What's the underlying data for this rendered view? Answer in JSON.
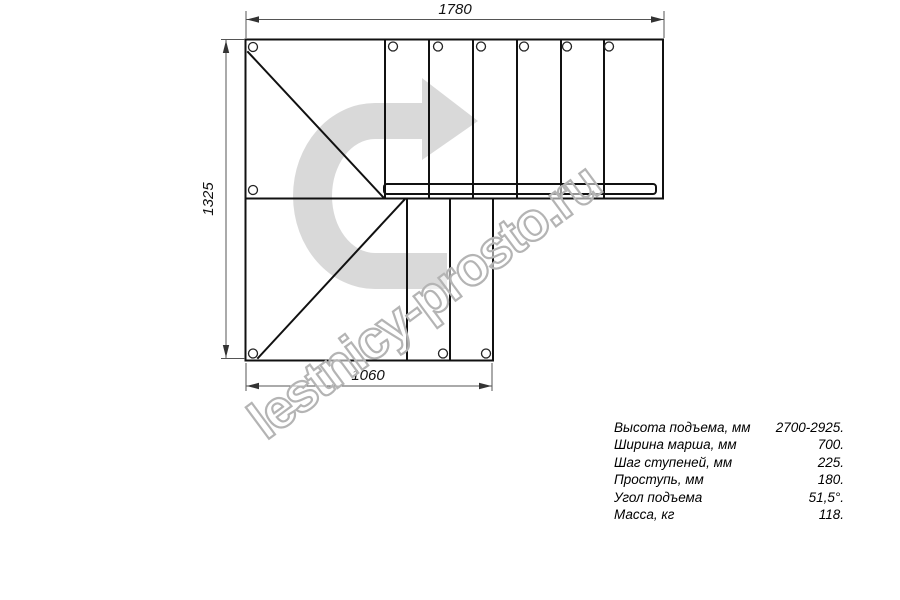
{
  "drawing": {
    "type": "staircase-plan-top-view",
    "dim_width_top": "1780",
    "dim_height_left": "1325",
    "dim_width_bottom": "1060",
    "upper_flight_treads": 6,
    "lower_flight_treads": 2
  },
  "specs": {
    "rows": [
      {
        "label": "Высота подъема, мм",
        "value": "2700-2925."
      },
      {
        "label": "Ширина марша, мм",
        "value": "700."
      },
      {
        "label": "Шаг ступеней, мм",
        "value": "225."
      },
      {
        "label": "Проступь, мм",
        "value": "180."
      },
      {
        "label": "Угол подъема",
        "value": "51,5°."
      },
      {
        "label": "Масса, кг",
        "value": "118."
      }
    ]
  },
  "watermark": {
    "text": "lestnicy-prosto.ru"
  },
  "colors": {
    "arrow": "#d9d9d9",
    "watermark_stroke": "#b4b4b4",
    "line": "#111111",
    "dim": "#555555"
  }
}
